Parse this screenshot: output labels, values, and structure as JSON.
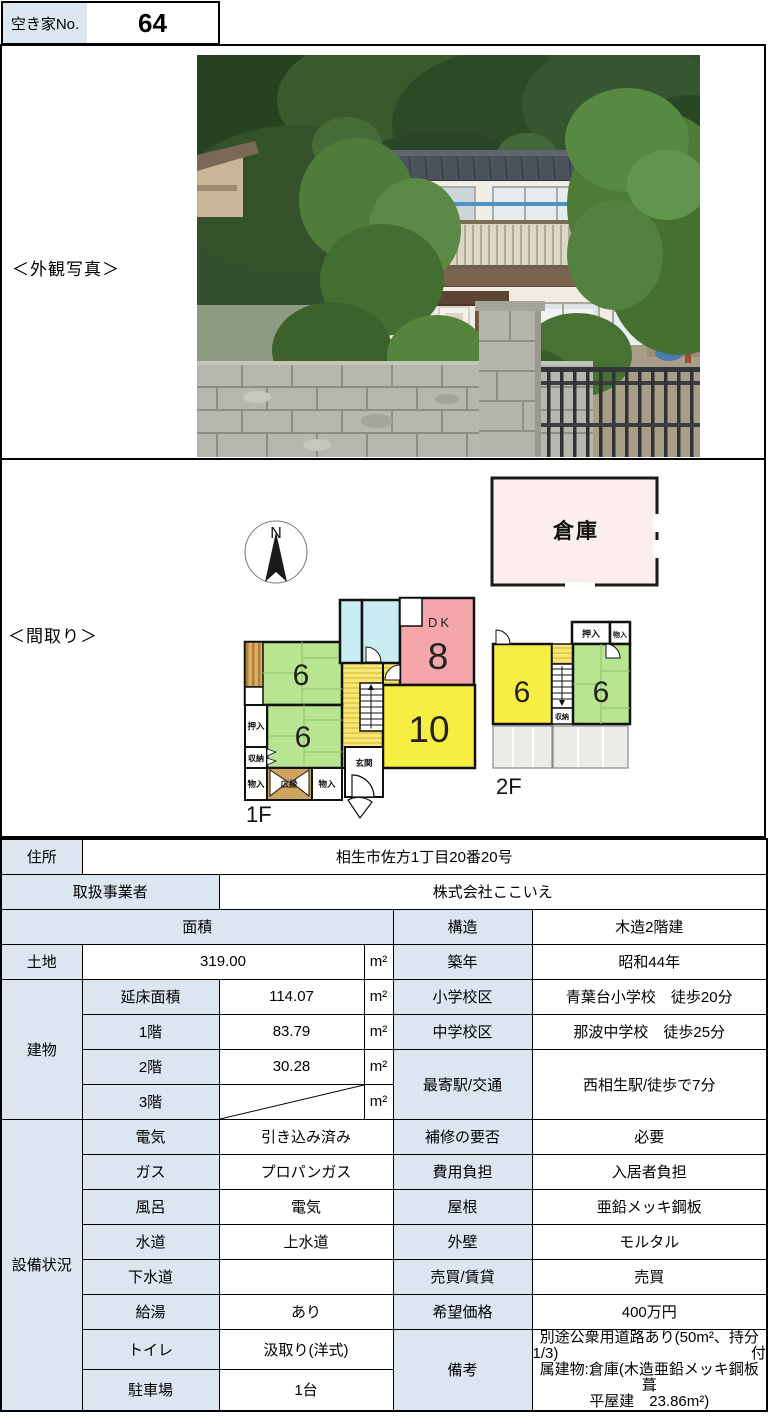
{
  "header": {
    "label": "空き家No.",
    "number": "64"
  },
  "photo": {
    "section_label": "＜外観写真＞"
  },
  "floorplan": {
    "section_label": "＜間取り＞",
    "north": "N",
    "warehouse": "倉庫",
    "f1_caption": "1F",
    "f2_caption": "2F",
    "f1": {
      "tatami_upper": "6",
      "tatami_lower": "6",
      "dk": "DK",
      "dk_size": "8",
      "living": "10",
      "closet_oshiire": "押入",
      "closet_shuno": "収納",
      "closet_monoire_l": "物入",
      "veranda": "広縁",
      "closet_monoire_r": "物入",
      "entrance": "玄関"
    },
    "f2": {
      "room_left": "6",
      "room_right": "6",
      "closet_oshiire": "押入",
      "closet_monoire": "物入",
      "closet_shuno": "収納"
    }
  },
  "table": {
    "address": {
      "label": "住所",
      "value": "相生市佐方1丁目20番20号"
    },
    "agent": {
      "label": "取扱事業者",
      "value": "株式会社ここいえ"
    },
    "area_header": "面積",
    "structure": {
      "label": "構造",
      "value": "木造2階建"
    },
    "land": {
      "label": "土地",
      "value": "319.00",
      "unit": "m²"
    },
    "built": {
      "label": "築年",
      "value": "昭和44年"
    },
    "building": {
      "label": "建物",
      "rows": [
        {
          "label": "延床面積",
          "value": "114.07",
          "unit": "m²"
        },
        {
          "label": "1階",
          "value": "83.79",
          "unit": "m²"
        },
        {
          "label": "2階",
          "value": "30.28",
          "unit": "m²"
        },
        {
          "label": "3階",
          "value": "",
          "unit": "m²"
        }
      ]
    },
    "elementary": {
      "label": "小学校区",
      "value": "青葉台小学校　徒歩20分"
    },
    "junior_high": {
      "label": "中学校区",
      "value": "那波中学校　徒歩25分"
    },
    "station": {
      "label": "最寄駅/交通",
      "value": "西相生駅/徒歩で7分"
    },
    "facilities": {
      "label": "設備状況",
      "rows": [
        {
          "label": "電気",
          "value": "引き込み済み"
        },
        {
          "label": "ガス",
          "value": "プロパンガス"
        },
        {
          "label": "風呂",
          "value": "電気"
        },
        {
          "label": "水道",
          "value": "上水道"
        },
        {
          "label": "下水道",
          "value": ""
        },
        {
          "label": "給湯",
          "value": "あり"
        },
        {
          "label": "トイレ",
          "value": "汲取り(洋式)"
        },
        {
          "label": "駐車場",
          "value": "1台"
        }
      ]
    },
    "right_rows": [
      {
        "label": "補修の要否",
        "value": "必要"
      },
      {
        "label": "費用負担",
        "value": "入居者負担"
      },
      {
        "label": "屋根",
        "value": "亜鉛メッキ鋼板"
      },
      {
        "label": "外壁",
        "value": "モルタル"
      },
      {
        "label": "売買/賃貸",
        "value": "売買"
      },
      {
        "label": "希望価格",
        "value": "400万円"
      }
    ],
    "remarks": {
      "label": "備考",
      "line1": "別途公衆用道路あり(50m²、持分",
      "line2_left": "1/3)",
      "line2_right": "付",
      "line3": "属建物:倉庫(木造亜鉛メッキ鋼板葺",
      "line4": "平屋建　23.86m²)"
    }
  },
  "colors": {
    "cell_shade": "#dce6f1",
    "tatami_green": "#b9e593",
    "room_yellow": "#f7ee44",
    "dk_pink": "#f4a6ab",
    "warehouse_pink": "#fdeeee",
    "bath_blue": "#c8ecf2"
  }
}
